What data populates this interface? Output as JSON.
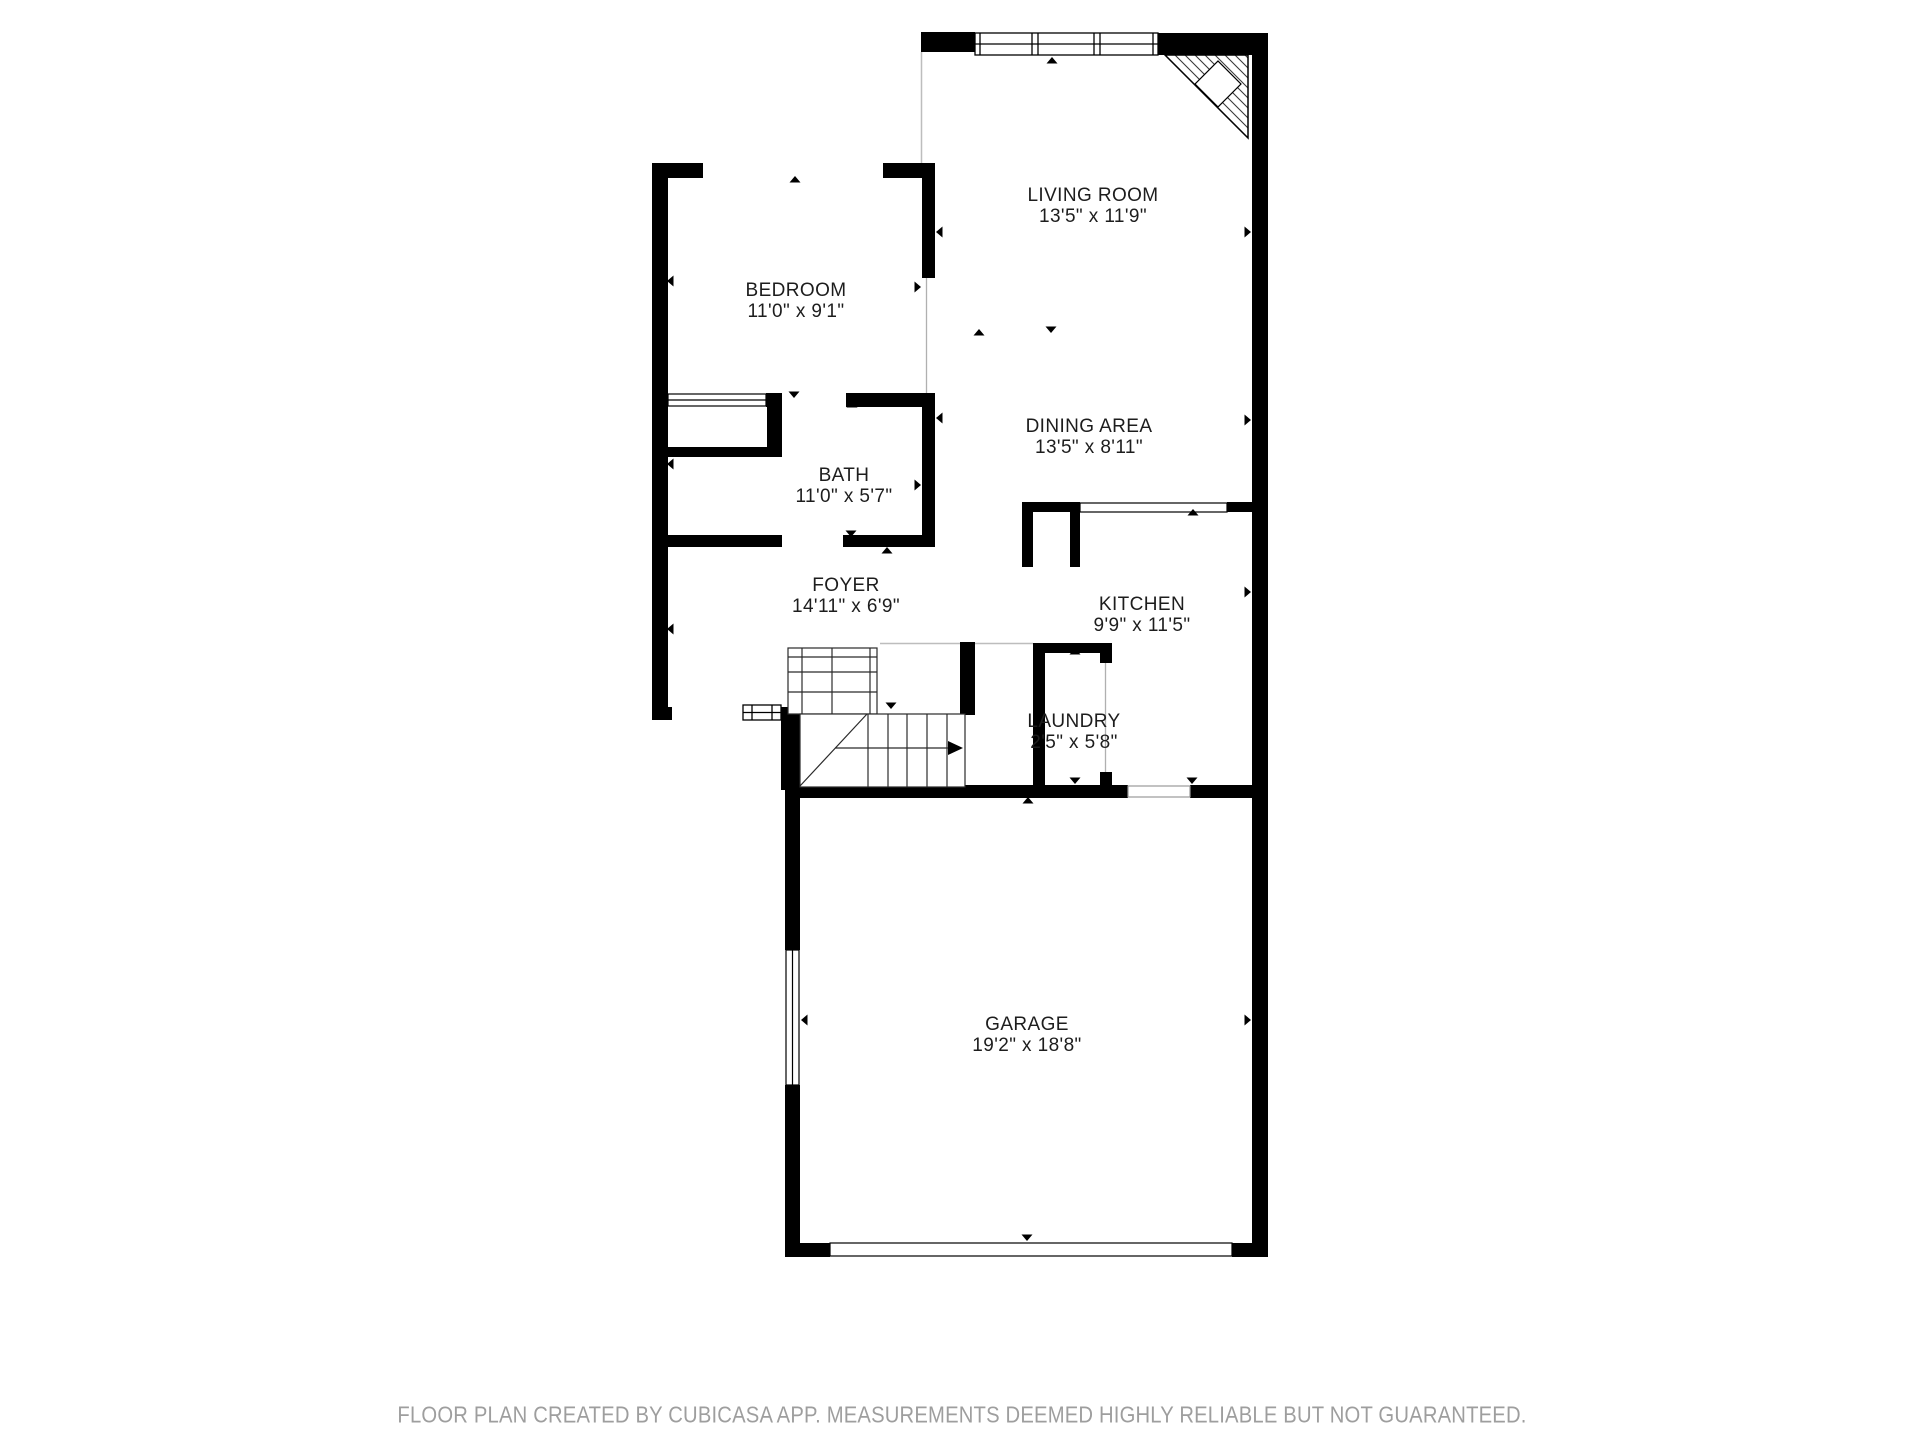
{
  "document": {
    "type": "floor-plan",
    "creator_app": "CubiCasa"
  },
  "rooms": [
    {
      "id": "living-room",
      "name": "LIVING ROOM",
      "dimensions": "13'5\" x 11'9\""
    },
    {
      "id": "bedroom",
      "name": "BEDROOM",
      "dimensions": "11'0\" x 9'1\""
    },
    {
      "id": "bath",
      "name": "BATH",
      "dimensions": "11'0\" x 5'7\""
    },
    {
      "id": "foyer",
      "name": "FOYER",
      "dimensions": "14'11\" x 6'9\""
    },
    {
      "id": "dining-area",
      "name": "DINING AREA",
      "dimensions": "13'5\" x 8'11\""
    },
    {
      "id": "kitchen",
      "name": "KITCHEN",
      "dimensions": "9'9\" x 11'5\""
    },
    {
      "id": "laundry",
      "name": "LAUNDRY",
      "dimensions": "2'5\" x 5'8\""
    },
    {
      "id": "garage",
      "name": "GARAGE",
      "dimensions": "19'2\" x 18'8\""
    }
  ],
  "symbols": {
    "fireplace": "corner-fireplace-top-right",
    "staircase": "staircase-with-direction-arrow",
    "window_top": "triple-pane-window",
    "garage_door": "wide-garage-door-opening",
    "entry_door": "front-entry-door",
    "closet_door": "sliding-closet-door",
    "pass_through": "kitchen-pass-through-counter"
  },
  "footer": {
    "text": "FLOOR PLAN CREATED BY CUBICASA APP. MEASUREMENTS DEEMED HIGHLY RELIABLE BUT NOT GUARANTEED."
  },
  "colors": {
    "walls": "#000000",
    "background": "#ffffff",
    "room_label": "#1d1d1d",
    "footer_text": "#9e9e9e",
    "boundary_line": "#bdbdbd"
  }
}
